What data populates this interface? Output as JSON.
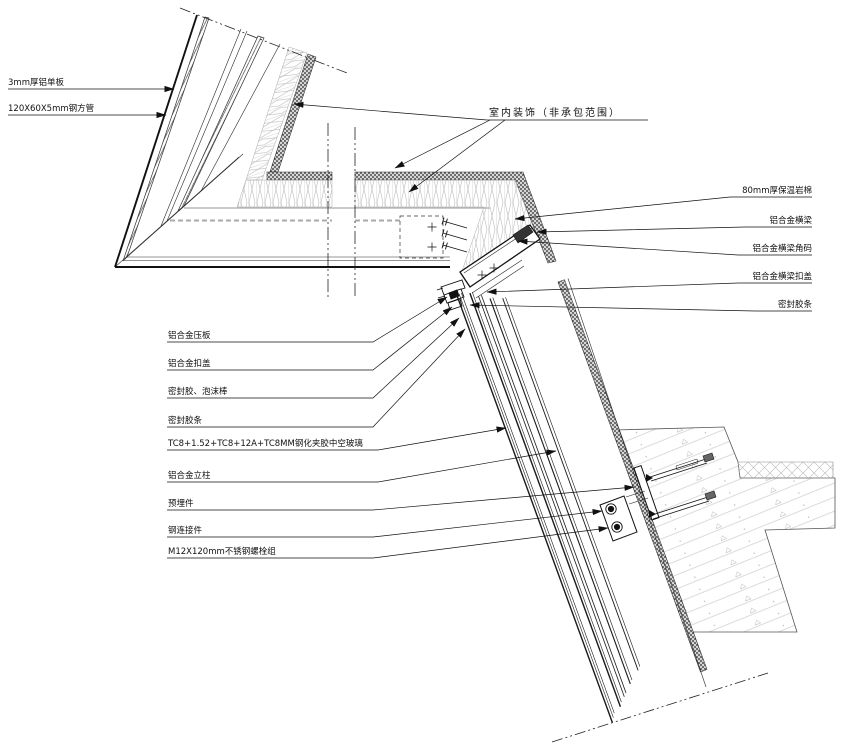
{
  "labels": {
    "top_left": [
      "3mm厚铝单板",
      "120X60X5mm钢方管"
    ],
    "interior_note": "室内装饰（非承包范围）",
    "right": [
      "80mm厚保温岩棉",
      "铝合金横梁",
      "铝合金横梁角码",
      "铝合金横梁扣盖",
      "密封胶条"
    ],
    "left": [
      "铝合金压板",
      "铝合金扣盖",
      "密封胶、泡沫棒",
      "密封胶条",
      "TC8+1.52+TC8+12A+TC8MM钢化夹胶中空玻璃",
      "铝合金立柱",
      "预埋件",
      "钢连接件",
      "M12X120mm不锈钢螺栓组"
    ]
  },
  "colors": {
    "line": "#1a1a1a",
    "light_hatch": "#b5b5b5",
    "stipple_dark": "#1a1a1a",
    "stipple_bg": "#d6d6d6"
  }
}
